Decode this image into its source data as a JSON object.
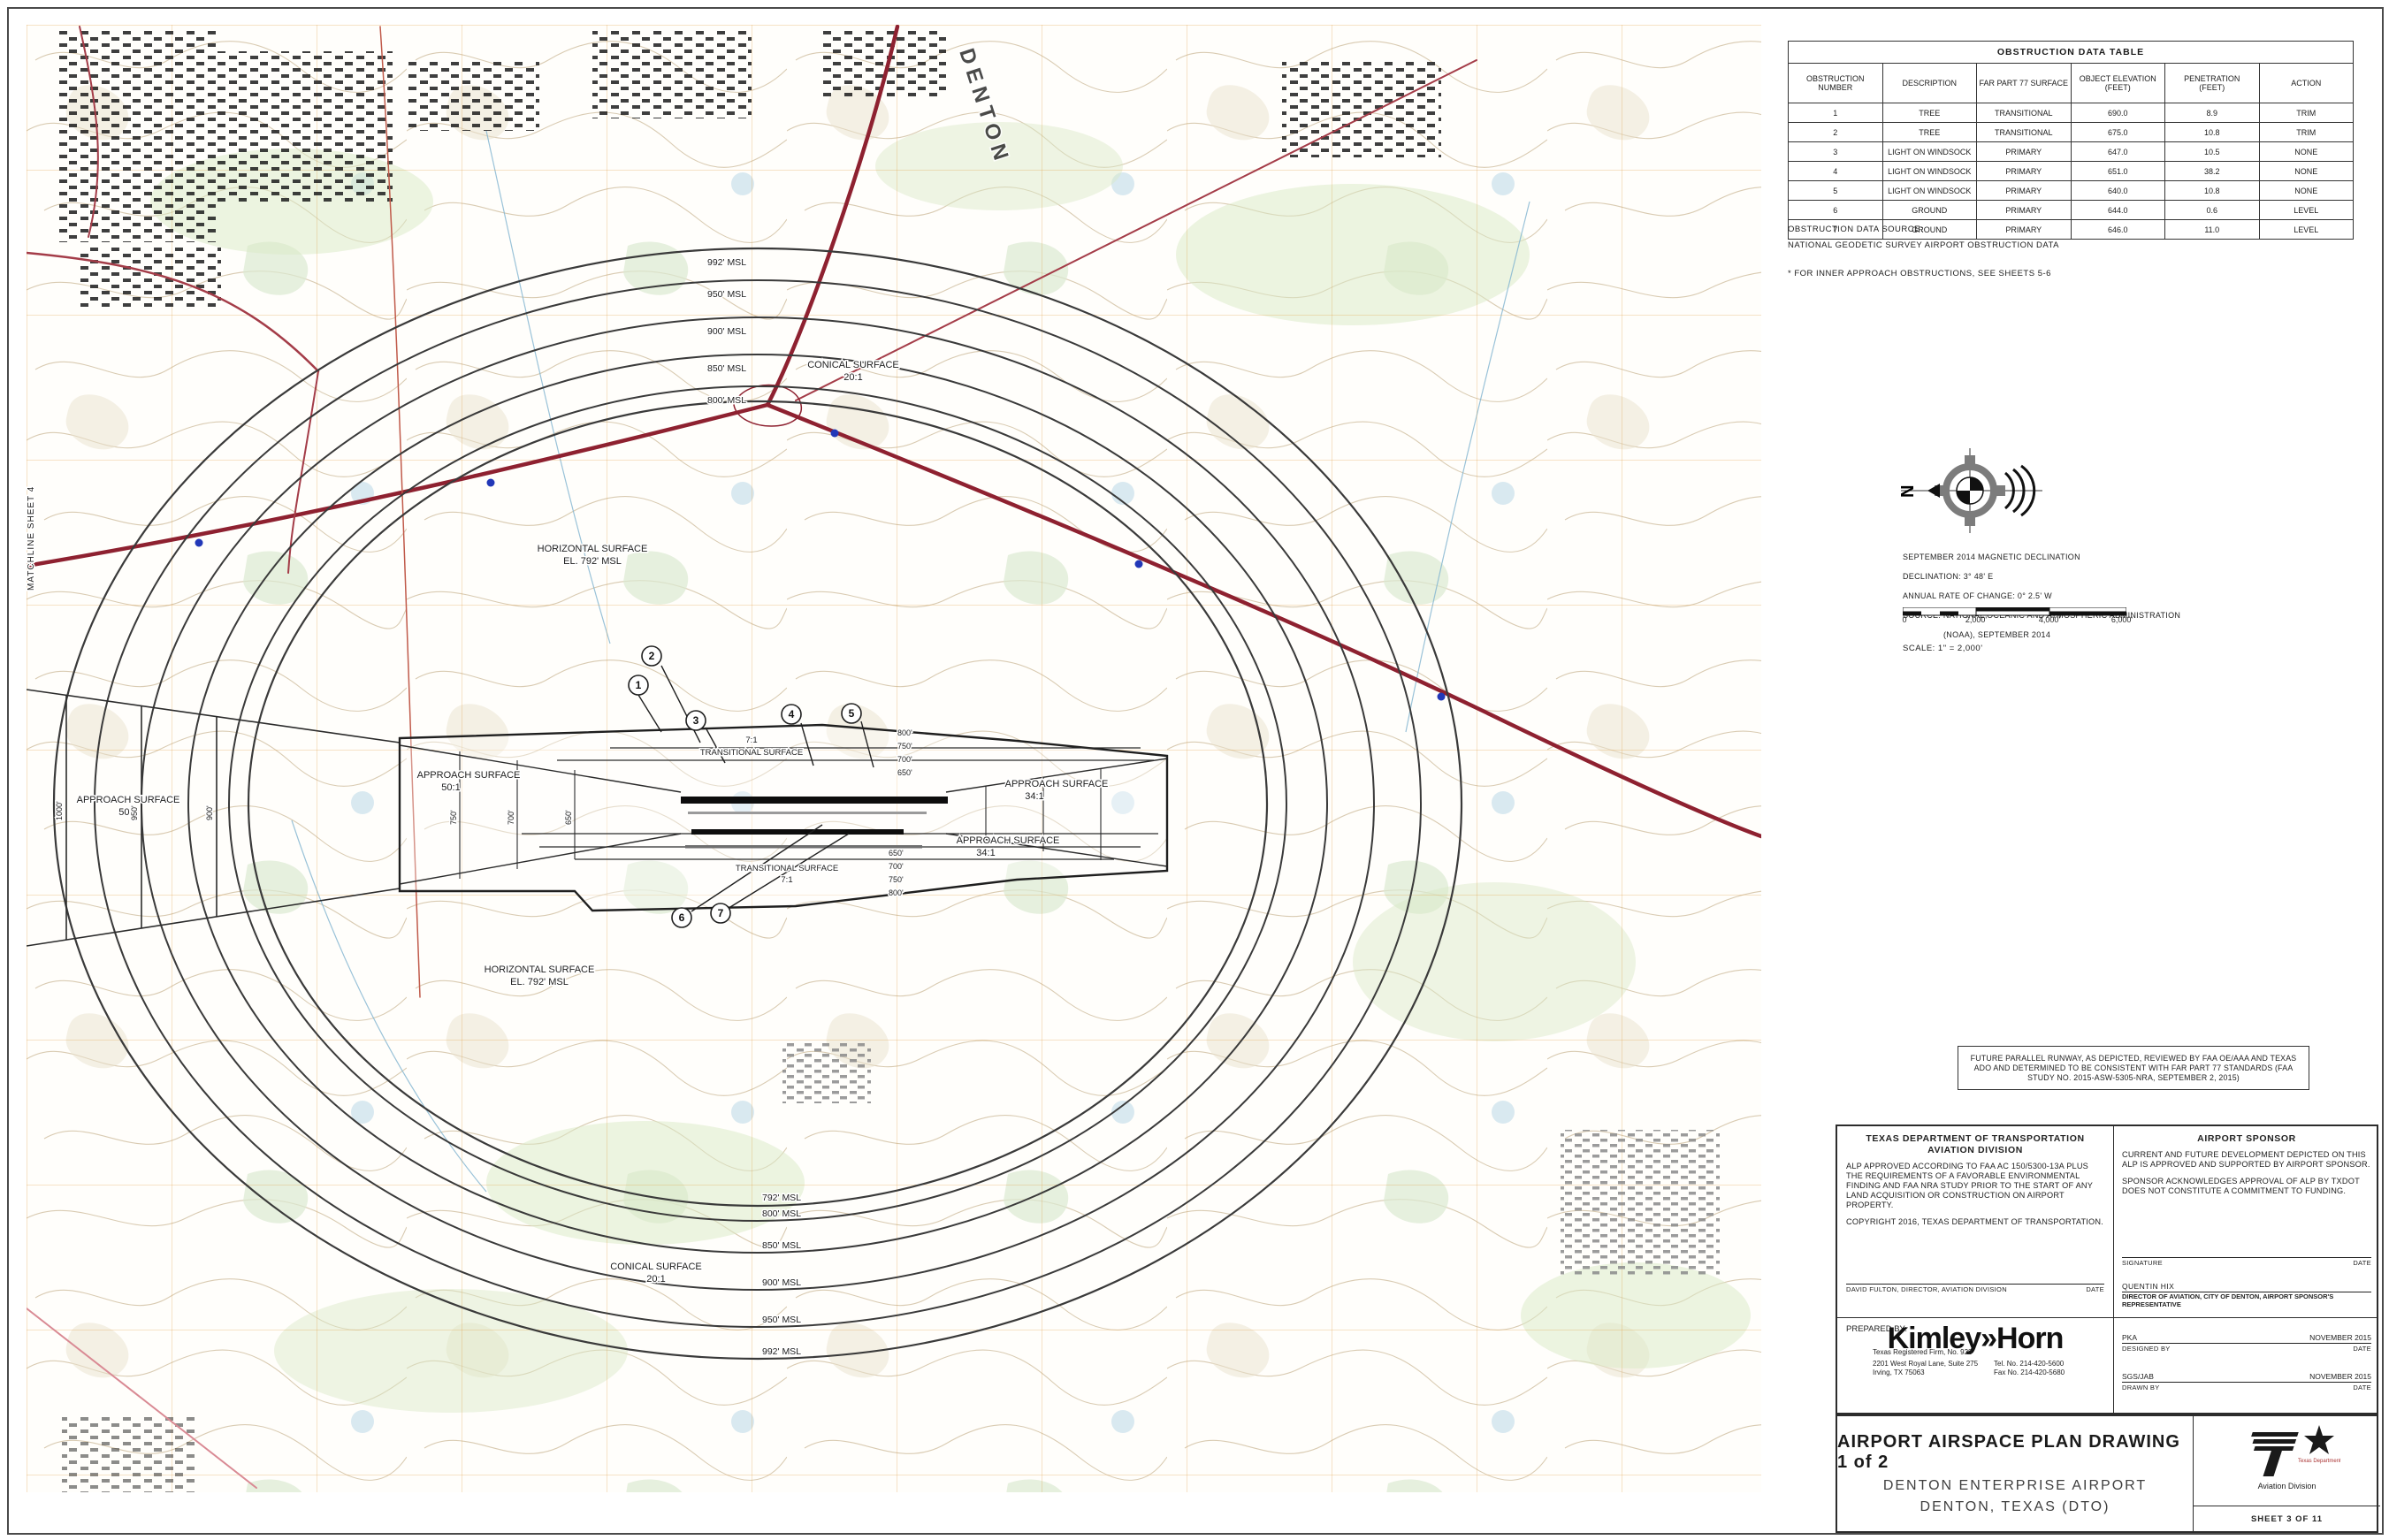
{
  "map": {
    "matchline": "MATCHLINE SHEET 4",
    "city_label": "DENTON",
    "horizontal_surface_line1": "HORIZONTAL SURFACE",
    "horizontal_surface_line2": "EL. 792' MSL",
    "conical_line1": "CONICAL SURFACE",
    "conical_line2": "20:1",
    "approach50_line1": "APPROACH SURFACE",
    "approach50_line2": "50:1",
    "approach34_line1": "APPROACH SURFACE",
    "approach34_line2": "34:1",
    "transitional_line1": "TRANSITIONAL SURFACE",
    "transitional_line2": "7:1",
    "ring_labels_north": [
      "992' MSL",
      "950' MSL",
      "900' MSL",
      "850' MSL",
      "800' MSL"
    ],
    "ring_labels_south": [
      "792' MSL",
      "800' MSL",
      "850' MSL",
      "900' MSL",
      "950' MSL",
      "992' MSL"
    ],
    "left_outer_ticks": [
      "1000'",
      "950'",
      "900'"
    ],
    "left_fan_ticks": [
      "750'",
      "700'",
      "650'"
    ],
    "right_stack_north": [
      "800'",
      "750'",
      "700'",
      "650'"
    ],
    "right_stack_south": [
      "650'",
      "700'",
      "750'",
      "800'"
    ],
    "obstruction_markers": [
      "1",
      "2",
      "3",
      "4",
      "5",
      "6",
      "7"
    ]
  },
  "obstruction_table": {
    "title": "OBSTRUCTION DATA TABLE",
    "headers": [
      "OBSTRUCTION\nNUMBER",
      "DESCRIPTION",
      "FAR PART 77 SURFACE",
      "OBJECT ELEVATION\n(FEET)",
      "PENETRATION\n(FEET)",
      "ACTION"
    ],
    "rows": [
      {
        "number": "1",
        "description": "TREE",
        "surface": "TRANSITIONAL",
        "elevation": "690.0",
        "penetration": "8.9",
        "action": "TRIM"
      },
      {
        "number": "2",
        "description": "TREE",
        "surface": "TRANSITIONAL",
        "elevation": "675.0",
        "penetration": "10.8",
        "action": "TRIM"
      },
      {
        "number": "3",
        "description": "LIGHT ON WINDSOCK",
        "surface": "PRIMARY",
        "elevation": "647.0",
        "penetration": "10.5",
        "action": "NONE"
      },
      {
        "number": "4",
        "description": "LIGHT ON WINDSOCK",
        "surface": "PRIMARY",
        "elevation": "651.0",
        "penetration": "38.2",
        "action": "NONE"
      },
      {
        "number": "5",
        "description": "LIGHT ON WINDSOCK",
        "surface": "PRIMARY",
        "elevation": "640.0",
        "penetration": "10.8",
        "action": "NONE"
      },
      {
        "number": "6",
        "description": "GROUND",
        "surface": "PRIMARY",
        "elevation": "644.0",
        "penetration": "0.6",
        "action": "LEVEL"
      },
      {
        "number": "7",
        "description": "GROUND",
        "surface": "PRIMARY",
        "elevation": "646.0",
        "penetration": "11.0",
        "action": "LEVEL"
      }
    ],
    "source_label": "OBSTRUCTION DATA SOURCE:",
    "source_value": "NATIONAL GEODETIC SURVEY AIRPORT OBSTRUCTION DATA",
    "footnote": "* FOR INNER APPROACH OBSTRUCTIONS, SEE SHEETS 5-6"
  },
  "north_arrow": {
    "n_letter": "N"
  },
  "declination": {
    "line1": "SEPTEMBER 2014 MAGNETIC DECLINATION",
    "line2": "DECLINATION: 3° 48' E",
    "line3": "ANNUAL RATE OF CHANGE: 0° 2.5' W",
    "line4": "SOURCE: NATIONAL OCEANIC AND ATMOSPHERIC ADMINISTRATION",
    "line5": "(NOAA), SEPTEMBER 2014"
  },
  "scale_bar": {
    "ticks": [
      "0",
      "2,000'",
      "4,000'",
      "6,000'"
    ],
    "label": "SCALE: 1\" = 2,000'"
  },
  "future_runway_note": "FUTURE PARALLEL RUNWAY, AS DEPICTED, REVIEWED BY FAA OE/AAA AND TEXAS ADO AND DETERMINED TO BE CONSISTENT WITH FAR PART 77 STANDARDS (FAA STUDY NO. 2015-ASW-5305-NRA, SEPTEMBER 2, 2015)",
  "txdot_block": {
    "title": "TEXAS DEPARTMENT OF TRANSPORTATION\nAVIATION DIVISION",
    "paragraph1": "ALP APPROVED ACCORDING TO FAA AC 150/5300-13A PLUS THE REQUIREMENTS OF A FAVORABLE ENVIRONMENTAL FINDING AND FAA NRA STUDY PRIOR TO THE START OF ANY LAND ACQUISITION OR CONSTRUCTION ON AIRPORT PROPERTY.",
    "paragraph2": "COPYRIGHT 2016, TEXAS DEPARTMENT OF TRANSPORTATION.",
    "signature_name": "DAVID FULTON, DIRECTOR, AVIATION DIVISION",
    "date_label": "DATE"
  },
  "sponsor_block": {
    "title": "AIRPORT SPONSOR",
    "paragraph1": "CURRENT AND FUTURE DEVELOPMENT DEPICTED ON THIS ALP IS APPROVED AND SUPPORTED BY AIRPORT SPONSOR.",
    "paragraph2": "SPONSOR ACKNOWLEDGES APPROVAL OF ALP BY TXDOT DOES NOT CONSTITUTE A COMMITMENT TO FUNDING.",
    "signature_label": "SIGNATURE",
    "date_label": "DATE",
    "name": "QUENTIN HIX",
    "name_title": "DIRECTOR OF AVIATION, CITY OF DENTON, AIRPORT SPONSOR'S REPRESENTATIVE"
  },
  "prepared_by": {
    "label": "PREPARED BY:",
    "logo_text": "Kimley»Horn",
    "firm_line": "Texas Registered Firm, No. 928",
    "address_line1": "2201 West Royal Lane, Suite 275",
    "address_line2": "Irving, TX 75063",
    "phone": "Tel. No. 214-420-5600",
    "fax": "Fax No. 214-420-5680"
  },
  "signoff": {
    "designed_value": "PKA",
    "designed_label": "DESIGNED BY",
    "designed_date": "NOVEMBER 2015",
    "drawn_value": "SGS/JAB",
    "drawn_label": "DRAWN BY",
    "drawn_date": "NOVEMBER 2015",
    "date_label": "DATE"
  },
  "title_block": {
    "line1": "AIRPORT AIRSPACE PLAN DRAWING 1 of 2",
    "line2": "DENTON ENTERPRISE AIRPORT",
    "line3": "DENTON, TEXAS (DTO)",
    "agency": "Texas Department of Transportation",
    "division": "Aviation Division",
    "sheet": "SHEET 3 OF 11"
  },
  "colors": {
    "highway_red": "#8e2130",
    "grid_orange": "#e0993a",
    "contour_tan": "#c9b38f",
    "marker_blue": "#2238b8"
  }
}
